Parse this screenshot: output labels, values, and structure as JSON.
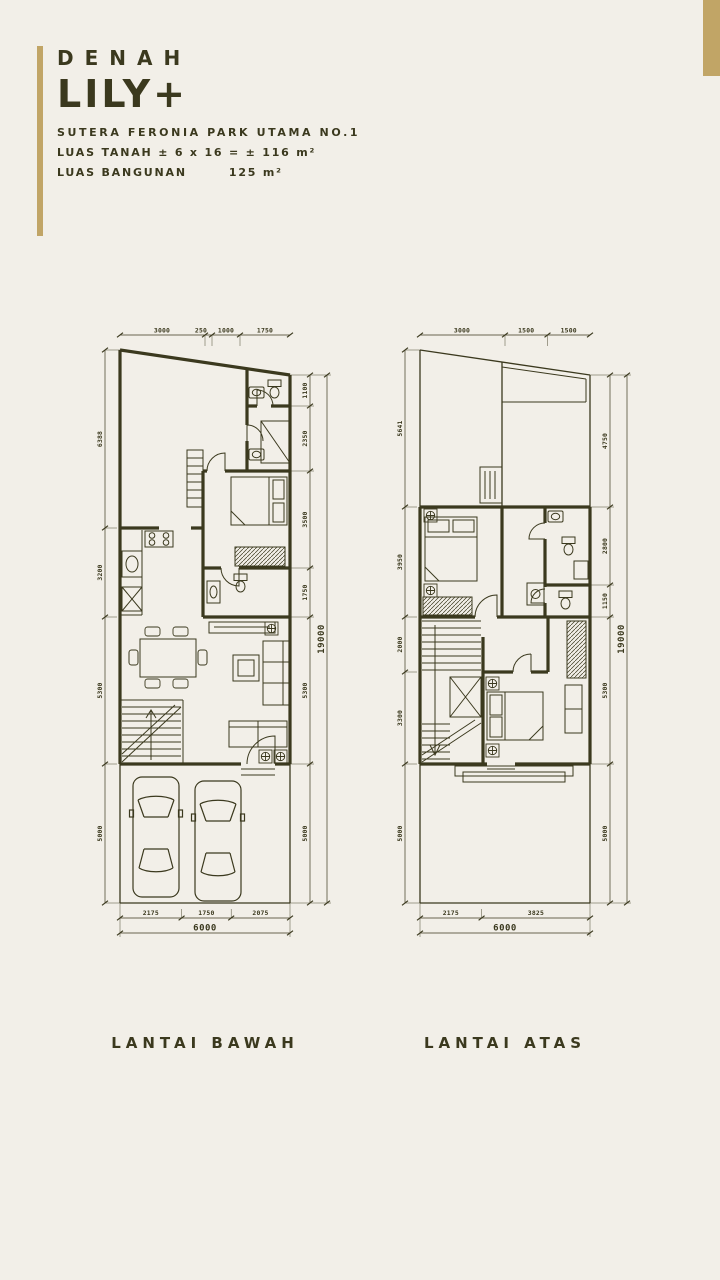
{
  "colors": {
    "background": "#F2EFE8",
    "ink": "#3B391E",
    "gold": "#C1A566"
  },
  "header": {
    "eyebrow": "DENAH",
    "title": "LILY+",
    "subtitle": "SUTERA FERONIA PARK UTAMA NO.1",
    "land_area": "LUAS TANAH ± 6 x 16 = ± 116 m²",
    "building_area_label": "LUAS BANGUNAN",
    "building_area_value": "125 m²"
  },
  "plans": {
    "lower": {
      "caption": "LANTAI BAWAH",
      "dims_top": [
        "3000",
        "250",
        "1000",
        "1750"
      ],
      "dims_left": [
        "6388",
        "3200",
        "5300",
        "5000"
      ],
      "dims_right": [
        "1100",
        "2350",
        "3500",
        "1750",
        "5300",
        "5000"
      ],
      "dims_right_total": "19000",
      "dims_bottom": [
        "2175",
        "1750",
        "2075"
      ],
      "dims_bottom_total": "6000"
    },
    "upper": {
      "caption": "LANTAI ATAS",
      "dims_top": [
        "3000",
        "1500",
        "1500"
      ],
      "dims_left": [
        "5641",
        "3950",
        "2000",
        "3300",
        "5000"
      ],
      "dims_right": [
        "4750",
        "2800",
        "1150",
        "5300",
        "5000"
      ],
      "dims_right_total": "19000",
      "dims_bottom": [
        "2175",
        "3825"
      ],
      "dims_bottom_total": "6000"
    }
  }
}
